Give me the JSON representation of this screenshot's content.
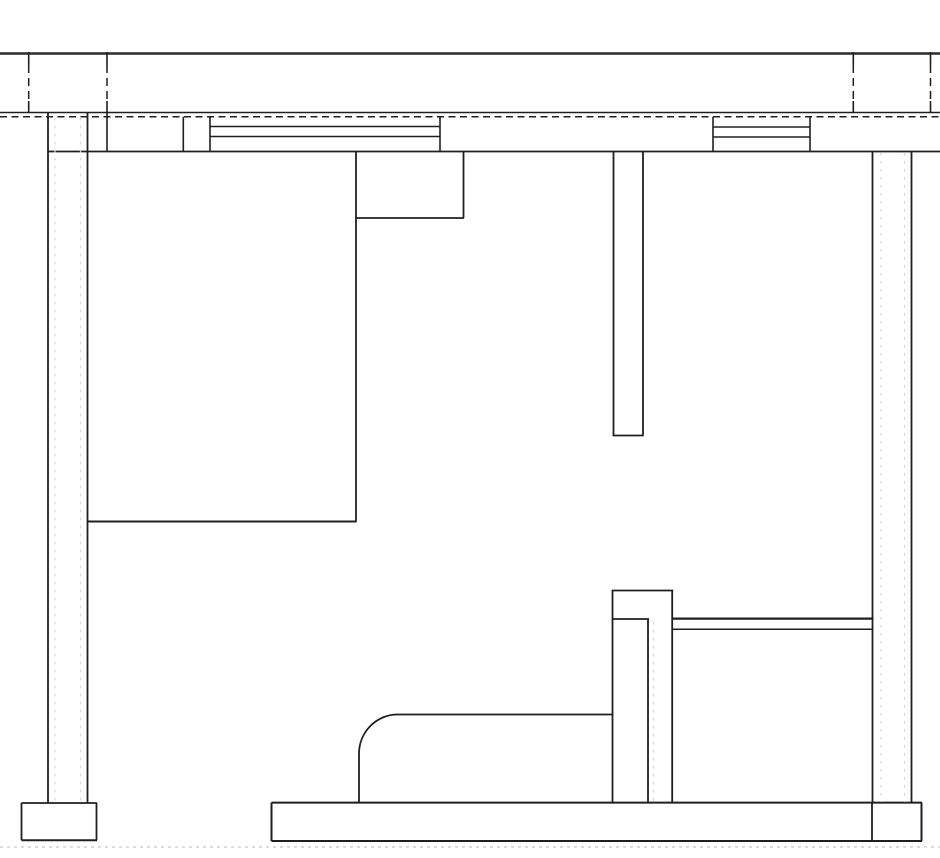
{
  "drawing": {
    "canvas": {
      "width": 940,
      "height": 858,
      "background": "#ffffff",
      "ink": "#1f1f1f",
      "heavy": "#2b2b2b",
      "faint": "#d4d4d4",
      "ground": "#c6c6c6"
    },
    "lines": [
      {
        "name": "top-rule-line",
        "o": "h",
        "x": 0,
        "y": 53.5,
        "len": 940,
        "w": 2.6,
        "color": "heavy"
      },
      {
        "name": "wall-top-line",
        "o": "h",
        "x": 0,
        "y": 112.5,
        "len": 940,
        "w": 1.6
      },
      {
        "name": "wall-top-hidden-line",
        "o": "h",
        "x": 0,
        "y": 116.8,
        "len": 940,
        "w": 1.5,
        "dash": "7 4.5"
      },
      {
        "name": "wall-bottom-line",
        "o": "h",
        "x": 48,
        "y": 151.5,
        "len": 892,
        "w": 1.8
      },
      {
        "name": "window-left-mullion-top",
        "o": "h",
        "x": 210,
        "y": 126.5,
        "len": 230,
        "w": 1.5
      },
      {
        "name": "window-left-mullion-bottom",
        "o": "h",
        "x": 210,
        "y": 136.5,
        "len": 230,
        "w": 1.5
      },
      {
        "name": "window-right-mullion-top",
        "o": "h",
        "x": 713,
        "y": 127,
        "len": 97,
        "w": 1.5
      },
      {
        "name": "window-right-mullion-bottom",
        "o": "h",
        "x": 713,
        "y": 137,
        "len": 97,
        "w": 1.5
      },
      {
        "name": "cabinet-notch-bottom-line",
        "o": "h",
        "x": 356,
        "y": 218,
        "len": 108,
        "w": 1.8
      },
      {
        "name": "cabinet-bottom-line",
        "o": "h",
        "x": 87.5,
        "y": 521.5,
        "len": 269,
        "w": 2.0
      },
      {
        "name": "partition-bottom-cap-line",
        "o": "h",
        "x": 612.6,
        "y": 435.5,
        "len": 31,
        "w": 1.8
      },
      {
        "name": "post-top-line",
        "o": "h",
        "x": 611.7,
        "y": 590.5,
        "len": 61.5,
        "w": 1.8
      },
      {
        "name": "post-step-line",
        "o": "h",
        "x": 613,
        "y": 619,
        "len": 36,
        "w": 1.8
      },
      {
        "name": "counter-rail-top-line",
        "o": "h",
        "x": 672,
        "y": 618.6,
        "len": 201.5,
        "w": 2.3
      },
      {
        "name": "counter-rail-bottom-line",
        "o": "h",
        "x": 672,
        "y": 629.2,
        "len": 201.5,
        "w": 1.5
      },
      {
        "name": "bench-top-line",
        "o": "h",
        "x": 397,
        "y": 714.5,
        "len": 216.5,
        "w": 1.8
      },
      {
        "name": "floor-slab-top-line",
        "o": "h",
        "x": 271.5,
        "y": 802.6,
        "len": 650.5,
        "w": 2.0
      },
      {
        "name": "floor-slab-bottom-line",
        "o": "h",
        "x": 271.5,
        "y": 841,
        "len": 650.5,
        "w": 2.0
      },
      {
        "name": "left-footing-top-line",
        "o": "h",
        "x": 21.5,
        "y": 803,
        "len": 75.5,
        "w": 1.8
      },
      {
        "name": "left-footing-bottom-line",
        "o": "h",
        "x": 21.5,
        "y": 840.2,
        "len": 75.5,
        "w": 2.0
      },
      {
        "name": "ground-hidden-line",
        "o": "h",
        "x": 0,
        "y": 847,
        "len": 940,
        "w": 1.2,
        "dash": "3 4",
        "color": "ground"
      },
      {
        "name": "grid-a-tick-top",
        "o": "v",
        "x": 28.7,
        "y": 52,
        "len": 13,
        "w": 1.6
      },
      {
        "name": "grid-a-dashes",
        "o": "v",
        "x": 28.7,
        "y": 65,
        "len": 36,
        "w": 1.5,
        "dash": "8 5"
      },
      {
        "name": "grid-a-tick-bottom",
        "o": "v",
        "x": 28.7,
        "y": 101,
        "len": 11.5,
        "w": 1.6
      },
      {
        "name": "grid-b-tick-top",
        "o": "v",
        "x": 107,
        "y": 52,
        "len": 13,
        "w": 1.6
      },
      {
        "name": "grid-b-dashes",
        "o": "v",
        "x": 107,
        "y": 65,
        "len": 36,
        "w": 1.5,
        "dash": "8 5"
      },
      {
        "name": "grid-b-tick-bottom",
        "o": "v",
        "x": 107,
        "y": 101,
        "len": 11.5,
        "w": 1.6
      },
      {
        "name": "grid-c-tick-top",
        "o": "v",
        "x": 853.3,
        "y": 52,
        "len": 13,
        "w": 1.6
      },
      {
        "name": "grid-c-dashes",
        "o": "v",
        "x": 853.3,
        "y": 65,
        "len": 36,
        "w": 1.5,
        "dash": "8 5"
      },
      {
        "name": "grid-c-tick-bottom",
        "o": "v",
        "x": 853.3,
        "y": 101,
        "len": 11.5,
        "w": 1.6
      },
      {
        "name": "grid-d-tick-top",
        "o": "v",
        "x": 930.5,
        "y": 52,
        "len": 13,
        "w": 1.6
      },
      {
        "name": "grid-d-dashes",
        "o": "v",
        "x": 930.5,
        "y": 65,
        "len": 36,
        "w": 1.5,
        "dash": "8 5"
      },
      {
        "name": "grid-d-tick-bottom",
        "o": "v",
        "x": 930.5,
        "y": 101,
        "len": 11.5,
        "w": 1.6
      },
      {
        "name": "left-wall-outer-line",
        "o": "v",
        "x": 48,
        "y": 112.5,
        "len": 690.5,
        "w": 1.8
      },
      {
        "name": "left-wall-inner-line",
        "o": "v",
        "x": 87.5,
        "y": 112.5,
        "len": 690.5,
        "w": 1.8
      },
      {
        "name": "band-divider-a",
        "o": "v",
        "x": 107,
        "y": 112.5,
        "len": 39,
        "w": 1.6
      },
      {
        "name": "band-divider-b",
        "o": "v",
        "x": 183.3,
        "y": 116.8,
        "len": 34.7,
        "w": 1.6
      },
      {
        "name": "band-divider-c",
        "o": "v",
        "x": 210,
        "y": 116.8,
        "len": 34.7,
        "w": 1.6
      },
      {
        "name": "window-left-right-jamb",
        "o": "v",
        "x": 440,
        "y": 116.8,
        "len": 34.7,
        "w": 1.6
      },
      {
        "name": "window-right-left-jamb",
        "o": "v",
        "x": 713,
        "y": 116.8,
        "len": 34.7,
        "w": 1.6
      },
      {
        "name": "window-right-right-jamb",
        "o": "v",
        "x": 810,
        "y": 116.8,
        "len": 34.7,
        "w": 1.6
      },
      {
        "name": "cabinet-right-line",
        "o": "v",
        "x": 356,
        "y": 151.5,
        "len": 370,
        "w": 1.8
      },
      {
        "name": "cabinet-notch-right-line",
        "o": "v",
        "x": 463.5,
        "y": 151.5,
        "len": 66.5,
        "w": 1.8
      },
      {
        "name": "partition-left-line",
        "o": "v",
        "x": 613.5,
        "y": 151.5,
        "len": 284,
        "w": 1.8
      },
      {
        "name": "partition-right-line",
        "o": "v",
        "x": 643,
        "y": 151.5,
        "len": 284,
        "w": 1.8
      },
      {
        "name": "right-wall-inner-line",
        "o": "v",
        "x": 872.5,
        "y": 151.5,
        "len": 651.1,
        "w": 1.8
      },
      {
        "name": "right-wall-outer-line",
        "o": "v",
        "x": 911.5,
        "y": 151.5,
        "len": 651.1,
        "w": 1.8
      },
      {
        "name": "post-left-line",
        "o": "v",
        "x": 612.5,
        "y": 590.5,
        "len": 212.1,
        "w": 1.8
      },
      {
        "name": "post-right-line",
        "o": "v",
        "x": 672.2,
        "y": 590.5,
        "len": 212.1,
        "w": 1.8
      },
      {
        "name": "post-inner-line",
        "o": "v",
        "x": 648,
        "y": 619,
        "len": 183.6,
        "w": 1.8
      },
      {
        "name": "bench-left-line",
        "o": "v",
        "x": 359,
        "y": 753.5,
        "len": 49.1,
        "w": 1.8
      },
      {
        "name": "slab-left-edge",
        "o": "v",
        "x": 271.5,
        "y": 802.6,
        "len": 38.4,
        "w": 2.0
      },
      {
        "name": "slab-footing-divider",
        "o": "v",
        "x": 872,
        "y": 802.6,
        "len": 38.4,
        "w": 1.8
      },
      {
        "name": "slab-right-edge",
        "o": "v",
        "x": 921.5,
        "y": 802.6,
        "len": 38.4,
        "w": 2.0
      },
      {
        "name": "left-footing-left-edge",
        "o": "v",
        "x": 21.5,
        "y": 803,
        "len": 37.2,
        "w": 1.8
      },
      {
        "name": "left-footing-right-edge",
        "o": "v",
        "x": 96.5,
        "y": 803,
        "len": 37.2,
        "w": 1.8
      },
      {
        "name": "left-wall-layer-line-a",
        "o": "v",
        "x": 55,
        "y": 118,
        "len": 684,
        "w": 1.2,
        "dash": "2.5 5.5",
        "color": "faint"
      },
      {
        "name": "left-wall-layer-line-b",
        "o": "v",
        "x": 80.5,
        "y": 118,
        "len": 684,
        "w": 1.2,
        "dash": "2.5 5.5",
        "color": "faint"
      },
      {
        "name": "right-wall-layer-line-a",
        "o": "v",
        "x": 881,
        "y": 153,
        "len": 649,
        "w": 1.2,
        "dash": "2.5 5.5",
        "color": "faint"
      },
      {
        "name": "right-wall-layer-line-b",
        "o": "v",
        "x": 904.5,
        "y": 153,
        "len": 649,
        "w": 1.2,
        "dash": "2.5 5.5",
        "color": "faint"
      },
      {
        "name": "post-layer-line",
        "o": "v",
        "x": 653.5,
        "y": 622,
        "len": 179,
        "w": 1.2,
        "dash": "2.5 5.5",
        "color": "faint"
      }
    ],
    "paths": [
      {
        "name": "bench-corner-arc",
        "d": "M 359 753.8 A 38.5 39.3 0 0 1 397.6 714.5",
        "w": 1.8
      }
    ]
  }
}
